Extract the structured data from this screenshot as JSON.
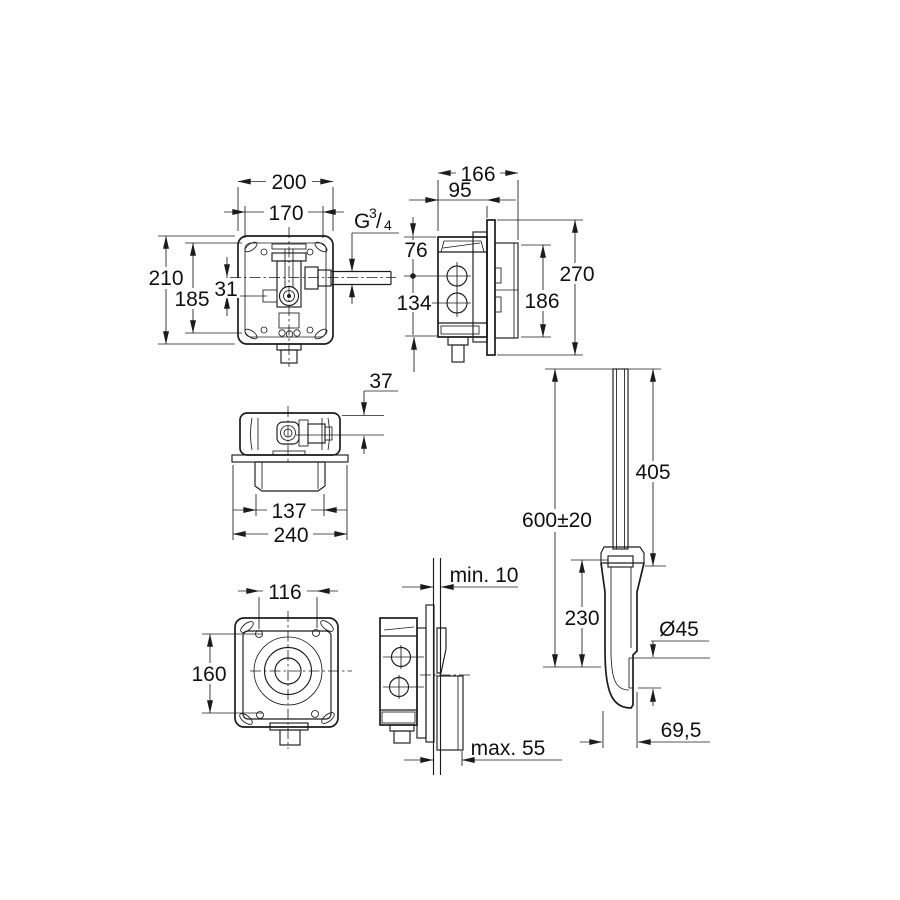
{
  "views": {
    "front": {
      "dims": {
        "outer_width": "200",
        "hole_spacing": "170",
        "outer_height": "210",
        "inner_height": "185",
        "axis_offset": "31",
        "thread": {
          "g": "G",
          "num": "3",
          "slash": "/",
          "den": "4"
        }
      }
    },
    "side": {
      "dims": {
        "depth_total": "166",
        "depth_front": "95",
        "hole1_offset": "76",
        "hole2_offset": "134",
        "plate_height": "270",
        "box_height": "186"
      }
    },
    "top": {
      "dims": {
        "front_offset": "37",
        "recess_width": "137",
        "plate_width": "240"
      }
    },
    "cover": {
      "dims": {
        "screw_width": "116",
        "screw_height": "160"
      }
    },
    "wall": {
      "dims": {
        "min_depth": "min. 10",
        "max_depth": "max. 55"
      }
    },
    "pipe": {
      "dims": {
        "install_height": "600±20",
        "upper_length": "405",
        "lower_length": "230",
        "outlet_diameter": "Ø45",
        "outlet_offset": "69,5"
      }
    }
  }
}
